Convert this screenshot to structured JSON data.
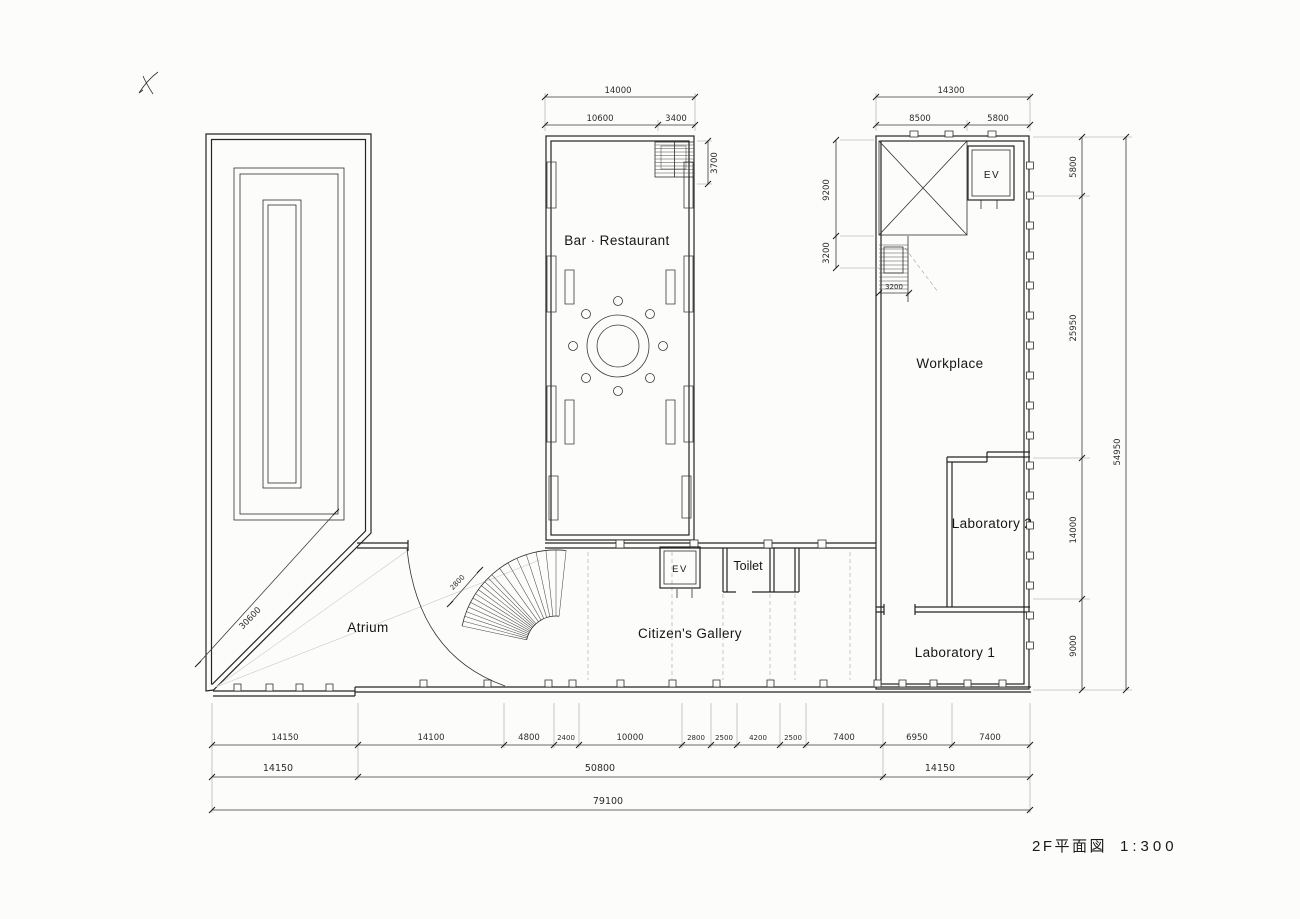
{
  "palette": {
    "paper": "#fcfcfa",
    "ink": "#242424",
    "pencil": "#9b9b9b"
  },
  "caption": {
    "title": "2F平面図",
    "scale": "1:300"
  },
  "marks": {
    "hand_mark": "check-squiggle"
  },
  "rooms": {
    "bar_restaurant": "Bar · Restaurant",
    "workplace": "Workplace",
    "laboratory_2": "Laboratory 2",
    "laboratory_1": "Laboratory 1",
    "atrium": "Atrium",
    "citizens_gallery": "Citizen's Gallery",
    "toilet": "Toilet",
    "ev_wing": "EV",
    "ev_gallery": "EV"
  },
  "dims": {
    "bar_top_total": "14000",
    "bar_top_left": "10600",
    "bar_top_right": "3400",
    "bar_stair_depth": "3700",
    "wing_top_total": "14300",
    "wing_top_left": "8500",
    "wing_top_right": "5800",
    "wing_left_upper": "9200",
    "wing_left_lower": "3200",
    "wing_stair_width": "3200",
    "right_top": "5800",
    "right_mid": "25950",
    "right_lab2": "14000",
    "right_lab1": "9000",
    "right_total": "54950",
    "atrium_diagonal": "30600",
    "spiral_stair": "2800",
    "row1": [
      "14150",
      "14100",
      "4800",
      "2400",
      "10000",
      "2800",
      "2500",
      "4200",
      "2500",
      "7400",
      "6950",
      "7400"
    ],
    "row2": [
      "14150",
      "50800",
      "14150"
    ],
    "row3": "79100"
  }
}
